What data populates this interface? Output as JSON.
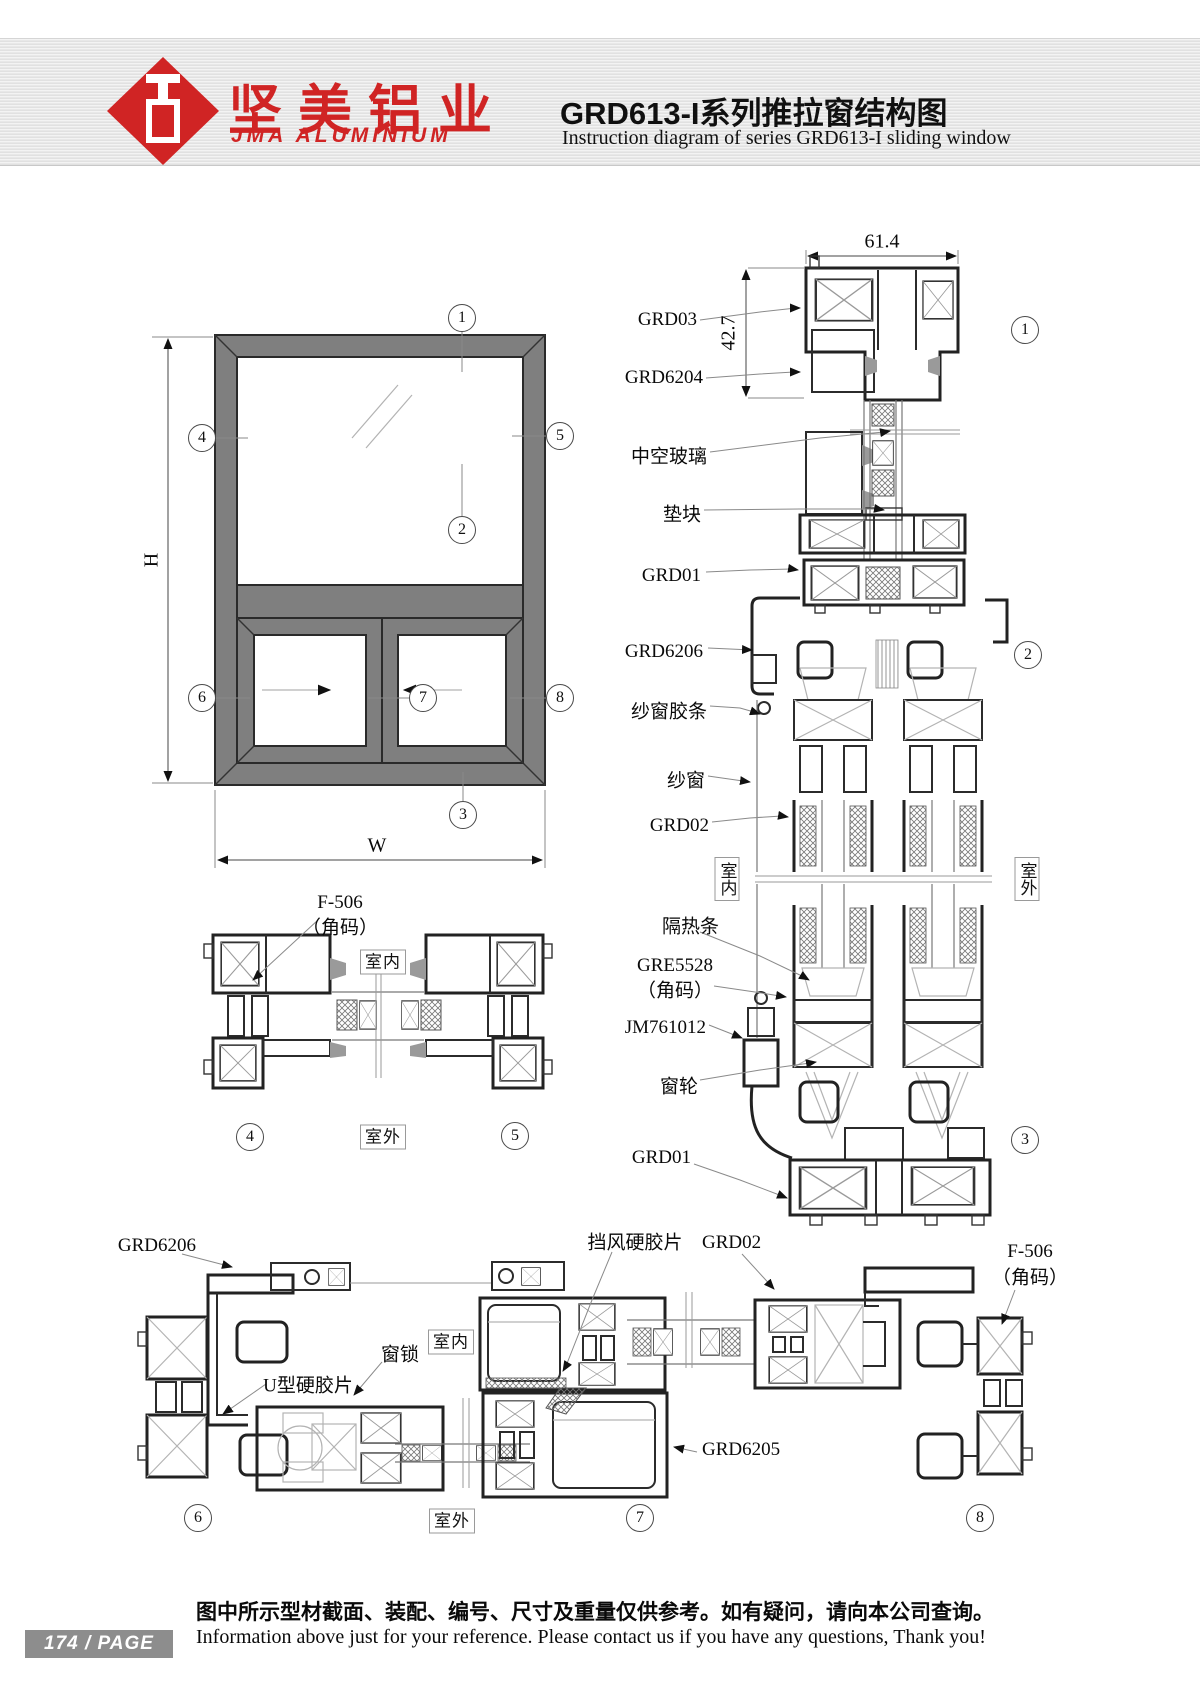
{
  "header": {
    "logo_text_cn": "坚美铝业",
    "logo_text_en": "JMA ALUMINIUM",
    "title_cn": "GRD613-I系列推拉窗结构图",
    "title_en": "Instruction diagram of series GRD613-I sliding window"
  },
  "rooms": {
    "indoor": "室内",
    "outdoor": "室外"
  },
  "callouts": {
    "c1": "1",
    "c2": "2",
    "c3": "3",
    "c4": "4",
    "c5": "5",
    "c6": "6",
    "c7": "7",
    "c8": "8"
  },
  "elevation": {
    "dim_h": "H",
    "dim_w": "W"
  },
  "section_45": {
    "f506": "F-506",
    "f506_sub": "（角码）"
  },
  "section_right": {
    "dim_width": "61.4",
    "dim_height": "42.7",
    "grd03": "GRD03",
    "grd6204": "GRD6204",
    "insulating_glass": "中空玻璃",
    "setting_block": "垫块",
    "grd01_top": "GRD01",
    "grd6206": "GRD6206",
    "screen_gasket": "纱窗胶条",
    "screen": "纱窗",
    "grd02": "GRD02",
    "thermal_break": "隔热条",
    "gre5528": "GRE5528",
    "gre5528_sub": "（角码）",
    "jm761012": "JM761012",
    "roller": "窗轮",
    "grd01_bottom": "GRD01"
  },
  "section_bottom": {
    "grd6206": "GRD6206",
    "u_strip": "U型硬胶片",
    "window_lock": "窗锁",
    "wind_strip": "挡风硬胶片",
    "grd02": "GRD02",
    "f506": "F-506",
    "f506_sub": "（角码）",
    "grd6205": "GRD6205"
  },
  "footer": {
    "page_badge": "174 / PAGE",
    "note_cn": "图中所示型材截面、装配、编号、尺寸及重量仅供参考。如有疑问，请向本公司查询。",
    "note_en": "Information above just for your reference. Please contact us if you have any questions, Thank you!"
  }
}
